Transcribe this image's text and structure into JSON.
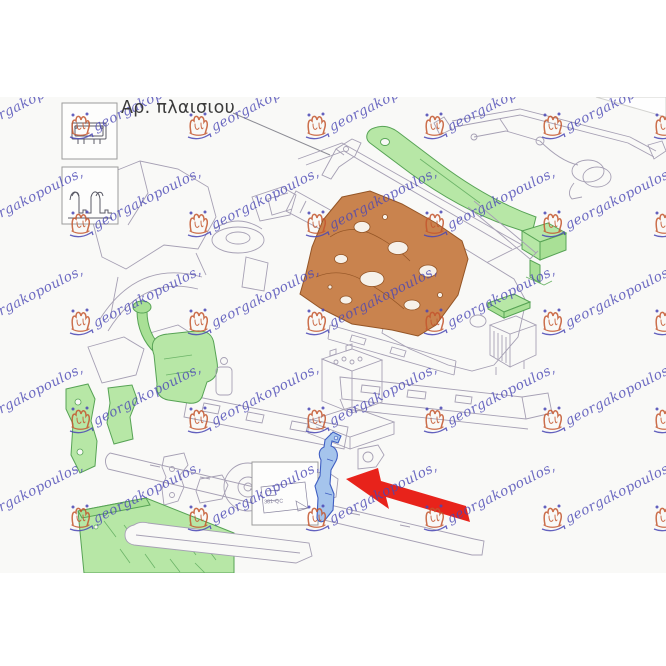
{
  "figure": {
    "title_label": "Αρ. πλαισιου",
    "sticker_code": "381-QC",
    "watermark": {
      "text": "georgakopoulos,",
      "text_color": "#4a47b5",
      "logo_color": "#c4562e"
    },
    "colors": {
      "green_fill": "#b7e7a6",
      "green_stroke": "#57a355",
      "orange_fill": "#c9834e",
      "orange_stroke": "#945526",
      "blue_fill": "#a5c4ec",
      "blue_stroke": "#3f5ec2",
      "arrow_red": "#e8231b",
      "lineart": "#a6a0b4"
    },
    "parts": [
      {
        "name": "chassis-number-plate-icon",
        "highlight": null
      },
      {
        "name": "profile-section-icon",
        "highlight": null
      },
      {
        "name": "cowl-top-strip",
        "highlight": "green"
      },
      {
        "name": "wiper-linkage",
        "highlight": null
      },
      {
        "name": "firewall-panel",
        "highlight": "orange"
      },
      {
        "name": "control-unit-box",
        "highlight": "green"
      },
      {
        "name": "relay-cover",
        "highlight": "green"
      },
      {
        "name": "washer-reservoir",
        "highlight": "green"
      },
      {
        "name": "fender-apron",
        "highlight": null
      },
      {
        "name": "fender-stay-brackets",
        "highlight": "green"
      },
      {
        "name": "horn",
        "highlight": null
      },
      {
        "name": "battery",
        "highlight": null
      },
      {
        "name": "frame-rails",
        "highlight": null
      },
      {
        "name": "skid-plate",
        "highlight": "green"
      },
      {
        "name": "label-sticker",
        "highlight": null
      },
      {
        "name": "side-bracket",
        "highlight": "blue",
        "indicated_by_arrow": true
      }
    ]
  }
}
